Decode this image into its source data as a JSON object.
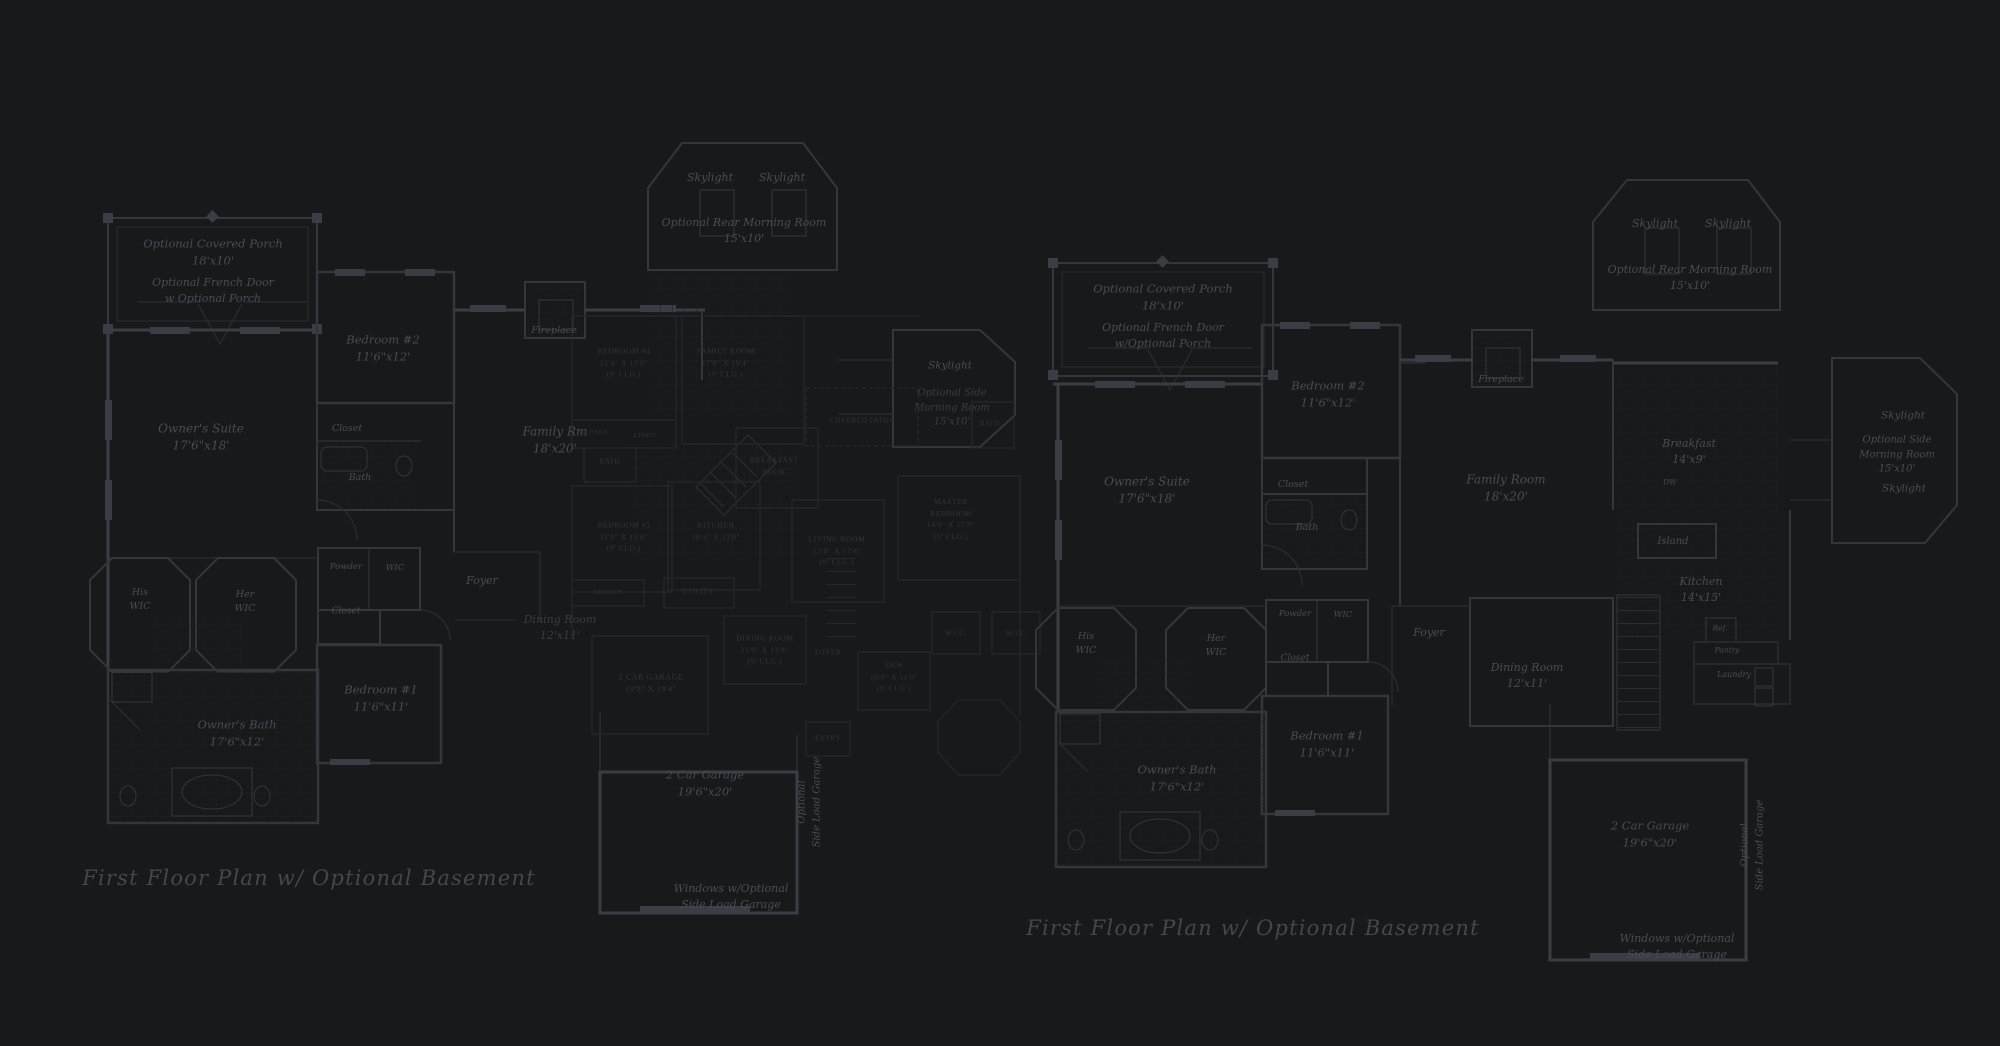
{
  "colors": {
    "background": "#18191b",
    "wall_line": "#34363c",
    "wall_bright": "#3b3d44",
    "wall_faint": "#2c2d33",
    "underlay_line": "#26272c",
    "label": "#4a4c55",
    "label_faint": "#3a3c43",
    "underlay_label": "#33353b",
    "caption": "#45474f",
    "tile_grid": "#1e2023",
    "tile_grid_bright": "#242630"
  },
  "plans": [
    {
      "name": "left-plan",
      "default_class": "",
      "labels": [
        {
          "id": "opt-covered-porch",
          "x": 213,
          "y": 252,
          "fs": 11.5,
          "lines": [
            "Optional Covered Porch",
            "18'x10'"
          ]
        },
        {
          "id": "opt-french-door",
          "x": 213,
          "y": 291,
          "fs": 11,
          "lines": [
            "Optional French Door",
            "w Optional Porch"
          ]
        },
        {
          "id": "bedroom2",
          "x": 383,
          "y": 348,
          "fs": 11.5,
          "lines": [
            "Bedroom #2",
            "11'6\"x12'"
          ]
        },
        {
          "id": "owners-suite",
          "x": 201,
          "y": 438,
          "fs": 12,
          "lines": [
            "Owner's Suite",
            "17'6\"x18'"
          ]
        },
        {
          "id": "closet-bedroom2",
          "x": 347,
          "y": 429,
          "fs": 9.5,
          "lines": [
            "Closet"
          ]
        },
        {
          "id": "bath",
          "x": 360,
          "y": 478,
          "fs": 9.5,
          "lines": [
            "Bath"
          ]
        },
        {
          "id": "family-rm",
          "x": 555,
          "y": 441,
          "fs": 12,
          "lines": [
            "Family Rm",
            "18'x20'"
          ]
        },
        {
          "id": "fireplace",
          "x": 554,
          "y": 331,
          "fs": 9.5,
          "lines": [
            "Fireplace"
          ]
        },
        {
          "id": "his-wic",
          "x": 140,
          "y": 600,
          "fs": 9.5,
          "lines": [
            "His",
            "WIC"
          ]
        },
        {
          "id": "her-wic",
          "x": 245,
          "y": 602,
          "fs": 9.5,
          "lines": [
            "Her",
            "WIC"
          ]
        },
        {
          "id": "powder",
          "x": 346,
          "y": 567,
          "fs": 8.5,
          "lines": [
            "Powder"
          ]
        },
        {
          "id": "wic",
          "x": 395,
          "y": 568,
          "fs": 8.5,
          "lines": [
            "WIC"
          ]
        },
        {
          "id": "closet2",
          "x": 346,
          "y": 612,
          "fs": 9,
          "lines": [
            "Closet"
          ]
        },
        {
          "id": "foyer",
          "x": 482,
          "y": 581,
          "fs": 11,
          "lines": [
            "Foyer"
          ]
        },
        {
          "id": "dining-room",
          "x": 560,
          "y": 628,
          "fs": 11,
          "cls": "faint",
          "lines": [
            "Dining Room",
            "12'x11'"
          ]
        },
        {
          "id": "bedroom1",
          "x": 381,
          "y": 698,
          "fs": 11.5,
          "lines": [
            "Bedroom #1",
            "11'6\"x11'"
          ]
        },
        {
          "id": "owners-bath",
          "x": 237,
          "y": 733,
          "fs": 11.5,
          "lines": [
            "Owner's Bath",
            "17'6\"x12'"
          ]
        },
        {
          "id": "garage",
          "x": 705,
          "y": 783,
          "fs": 11.5,
          "lines": [
            "2 Car Garage",
            "19'6\"x20'"
          ]
        },
        {
          "id": "side-load-garage",
          "x": 810,
          "y": 802,
          "fs": 10,
          "rot": -90,
          "lines": [
            "Optional",
            "Side Load Garage"
          ]
        },
        {
          "id": "windows-note",
          "x": 731,
          "y": 897,
          "fs": 11,
          "lines": [
            "Windows w/Optional",
            "Side Load Garage"
          ]
        },
        {
          "id": "rear-morning-room",
          "x": 744,
          "y": 231,
          "fs": 11,
          "lines": [
            "Optional Rear Morning Room",
            "15'x10'"
          ]
        },
        {
          "id": "skylight-rear-1",
          "x": 710,
          "y": 178,
          "fs": 11,
          "lines": [
            "Skylight"
          ]
        },
        {
          "id": "skylight-rear-2",
          "x": 782,
          "y": 178,
          "fs": 11,
          "lines": [
            "Skylight"
          ]
        },
        {
          "id": "skylight-side",
          "x": 950,
          "y": 366,
          "fs": 10.5,
          "lines": [
            "Skylight"
          ]
        },
        {
          "id": "side-morning-room",
          "x": 952,
          "y": 408,
          "fs": 10,
          "cls": "faint",
          "lines": [
            "Optional Side",
            "Morning Room",
            "15'x10'"
          ]
        },
        {
          "id": "caption",
          "x": 309,
          "y": 878,
          "fs": 21,
          "cls": "cap",
          "lines": [
            "First Floor Plan  w/ Optional Basement"
          ]
        }
      ]
    },
    {
      "name": "middle-underlay-plan",
      "default_class": "u",
      "labels": [
        {
          "id": "u-bedroom4",
          "x": 624,
          "y": 363,
          "fs": 7.5,
          "lines": [
            "BEDROOM #4",
            "12'4\" X 13'0\"",
            "(9' CLG.)"
          ]
        },
        {
          "id": "u-family-room",
          "x": 726,
          "y": 363,
          "fs": 7.5,
          "lines": [
            "FAMILY ROOM",
            "17'8\" X 19'4\"",
            "(9' CLG.)"
          ]
        },
        {
          "id": "u-closet1",
          "x": 594,
          "y": 433,
          "fs": 6.5,
          "lines": [
            "CLOSET"
          ]
        },
        {
          "id": "u-linen",
          "x": 645,
          "y": 436,
          "fs": 6.5,
          "lines": [
            "LINEN"
          ]
        },
        {
          "id": "u-bath1",
          "x": 610,
          "y": 462,
          "fs": 7,
          "lines": [
            "BATH"
          ]
        },
        {
          "id": "u-breakfast-nook",
          "x": 774,
          "y": 466,
          "fs": 7.5,
          "lines": [
            "BREAKFAST",
            "NOOK"
          ]
        },
        {
          "id": "u-kitchen",
          "x": 716,
          "y": 531,
          "fs": 7.5,
          "lines": [
            "KITCHEN",
            "10'4\" X 13'0\""
          ]
        },
        {
          "id": "u-bedroom5",
          "x": 624,
          "y": 537,
          "fs": 7.5,
          "lines": [
            "BEDROOM #5",
            "11'0\" X 13'0\"",
            "(9' CLG.)"
          ]
        },
        {
          "id": "u-closet2",
          "x": 608,
          "y": 593,
          "fs": 6.5,
          "lines": [
            "CLOSET"
          ]
        },
        {
          "id": "u-utility",
          "x": 698,
          "y": 592,
          "fs": 7,
          "lines": [
            "UTILITY"
          ]
        },
        {
          "id": "u-living-room",
          "x": 837,
          "y": 551,
          "fs": 7.5,
          "lines": [
            "LIVING ROOM",
            "13'0\" X 17'8\"",
            "(9' CLG.)"
          ]
        },
        {
          "id": "u-dining-room",
          "x": 765,
          "y": 650,
          "fs": 7.5,
          "lines": [
            "DINING ROOM",
            "11'0\" X 13'8\"",
            "(9' CLG.)"
          ]
        },
        {
          "id": "u-foyer",
          "x": 828,
          "y": 653,
          "fs": 7,
          "lines": [
            "FOYER"
          ]
        },
        {
          "id": "u-den",
          "x": 894,
          "y": 677,
          "fs": 7.5,
          "lines": [
            "DEN",
            "10'0\" X 11'0\"",
            "(9' CLG.)"
          ]
        },
        {
          "id": "u-master-bedroom",
          "x": 951,
          "y": 519,
          "fs": 7.5,
          "lines": [
            "MASTER",
            "BEDROOM",
            "14'0\" X 17'8\"",
            "(9' CLG.)"
          ]
        },
        {
          "id": "u-wic1",
          "x": 956,
          "y": 634,
          "fs": 7,
          "lines": [
            "W.I.C."
          ]
        },
        {
          "id": "u-wic2",
          "x": 1017,
          "y": 634,
          "fs": 7,
          "lines": [
            "W.I.C."
          ]
        },
        {
          "id": "u-covered-patio",
          "x": 861,
          "y": 421,
          "fs": 7,
          "lines": [
            "COVERED PATIO"
          ]
        },
        {
          "id": "u-bath2",
          "x": 990,
          "y": 424,
          "fs": 7,
          "lines": [
            "BATH"
          ]
        },
        {
          "id": "u-entry",
          "x": 828,
          "y": 739,
          "fs": 7,
          "lines": [
            "ENTRY"
          ]
        },
        {
          "id": "u-garage",
          "x": 651,
          "y": 684,
          "fs": 8,
          "lines": [
            "2 CAR GARAGE",
            "19'8\" X 19'4\""
          ]
        }
      ]
    },
    {
      "name": "right-plan",
      "default_class": "",
      "labels": [
        {
          "id": "opt-covered-porch-r",
          "x": 1163,
          "y": 297,
          "fs": 11.5,
          "lines": [
            "Optional Covered Porch",
            "18'x10'"
          ]
        },
        {
          "id": "opt-french-door-r",
          "x": 1163,
          "y": 336,
          "fs": 11,
          "lines": [
            "Optional French Door",
            "w/Optional Porch"
          ]
        },
        {
          "id": "bedroom2-r",
          "x": 1328,
          "y": 394,
          "fs": 11.5,
          "lines": [
            "Bedroom #2",
            "11'6\"x12'"
          ]
        },
        {
          "id": "closet-bedroom2-r",
          "x": 1293,
          "y": 485,
          "fs": 9.5,
          "lines": [
            "Closet"
          ]
        },
        {
          "id": "bath-r",
          "x": 1307,
          "y": 528,
          "fs": 9.5,
          "lines": [
            "Bath"
          ]
        },
        {
          "id": "owners-suite-r",
          "x": 1147,
          "y": 491,
          "fs": 12,
          "lines": [
            "Owner's Suite",
            "17'6\"x18'"
          ]
        },
        {
          "id": "family-room-r",
          "x": 1506,
          "y": 489,
          "fs": 12,
          "lines": [
            "Family Room",
            "18'x20'"
          ]
        },
        {
          "id": "fireplace-r",
          "x": 1501,
          "y": 380,
          "fs": 9.5,
          "lines": [
            "Fireplace"
          ]
        },
        {
          "id": "breakfast-r",
          "x": 1689,
          "y": 452,
          "fs": 11,
          "lines": [
            "Breakfast",
            "14'x9'"
          ]
        },
        {
          "id": "dw-r",
          "x": 1670,
          "y": 483,
          "fs": 7.5,
          "lines": [
            "DW"
          ]
        },
        {
          "id": "island-r",
          "x": 1673,
          "y": 542,
          "fs": 10,
          "lines": [
            "Island"
          ]
        },
        {
          "id": "kitchen-r",
          "x": 1701,
          "y": 590,
          "fs": 11,
          "lines": [
            "Kitchen",
            "14'x15'"
          ]
        },
        {
          "id": "ref-r",
          "x": 1720,
          "y": 629,
          "fs": 7.5,
          "lines": [
            "Ref."
          ]
        },
        {
          "id": "pantry-r",
          "x": 1727,
          "y": 651,
          "fs": 7.5,
          "lines": [
            "Pantry"
          ]
        },
        {
          "id": "laundry-r",
          "x": 1734,
          "y": 675,
          "fs": 8,
          "lines": [
            "Laundry"
          ]
        },
        {
          "id": "his-wic-r",
          "x": 1086,
          "y": 644,
          "fs": 9.5,
          "lines": [
            "His",
            "WIC"
          ]
        },
        {
          "id": "her-wic-r",
          "x": 1216,
          "y": 646,
          "fs": 9.5,
          "lines": [
            "Her",
            "WIC"
          ]
        },
        {
          "id": "powder-r",
          "x": 1295,
          "y": 614,
          "fs": 8.5,
          "lines": [
            "Powder"
          ]
        },
        {
          "id": "wic-r",
          "x": 1343,
          "y": 615,
          "fs": 8.5,
          "lines": [
            "WIC"
          ]
        },
        {
          "id": "closet2-r",
          "x": 1295,
          "y": 659,
          "fs": 9,
          "lines": [
            "Closet"
          ]
        },
        {
          "id": "foyer-r",
          "x": 1429,
          "y": 633,
          "fs": 11,
          "lines": [
            "Foyer"
          ]
        },
        {
          "id": "dining-room-r",
          "x": 1527,
          "y": 676,
          "fs": 11,
          "lines": [
            "Dining Room",
            "12'x11'"
          ]
        },
        {
          "id": "bedroom1-r",
          "x": 1327,
          "y": 744,
          "fs": 11.5,
          "lines": [
            "Bedroom #1",
            "11'6\"x11'"
          ]
        },
        {
          "id": "owners-bath-r",
          "x": 1177,
          "y": 778,
          "fs": 11.5,
          "lines": [
            "Owner's Bath",
            "17'6\"x12'"
          ]
        },
        {
          "id": "garage-r",
          "x": 1650,
          "y": 834,
          "fs": 11.5,
          "lines": [
            "2 Car Garage",
            "19'6\"x20'"
          ]
        },
        {
          "id": "side-load-garage-r",
          "x": 1753,
          "y": 845,
          "fs": 10,
          "rot": -90,
          "lines": [
            "Optional",
            "Side Load Garage"
          ]
        },
        {
          "id": "windows-note-r",
          "x": 1677,
          "y": 947,
          "fs": 11,
          "lines": [
            "Windows w/Optional",
            "Side Load Garage"
          ]
        },
        {
          "id": "rear-morning-room-r",
          "x": 1690,
          "y": 278,
          "fs": 11,
          "lines": [
            "Optional Rear Morning Room",
            "15'x10'"
          ]
        },
        {
          "id": "skylight-rear-r1",
          "x": 1655,
          "y": 224,
          "fs": 11,
          "lines": [
            "Skylight"
          ]
        },
        {
          "id": "skylight-rear-r2",
          "x": 1728,
          "y": 224,
          "fs": 11,
          "lines": [
            "Skylight"
          ]
        },
        {
          "id": "skylight-side-r1",
          "x": 1903,
          "y": 416,
          "fs": 10.5,
          "lines": [
            "Skylight"
          ]
        },
        {
          "id": "side-morning-room-r",
          "x": 1897,
          "y": 455,
          "fs": 10,
          "lines": [
            "Optional Side",
            "Morning Room",
            "15'x10'"
          ]
        },
        {
          "id": "skylight-side-r2",
          "x": 1904,
          "y": 489,
          "fs": 10.5,
          "lines": [
            "Skylight"
          ]
        },
        {
          "id": "caption-r",
          "x": 1253,
          "y": 928,
          "fs": 21,
          "cls": "cap",
          "lines": [
            "First Floor Plan  w/ Optional Basement"
          ]
        }
      ]
    }
  ]
}
